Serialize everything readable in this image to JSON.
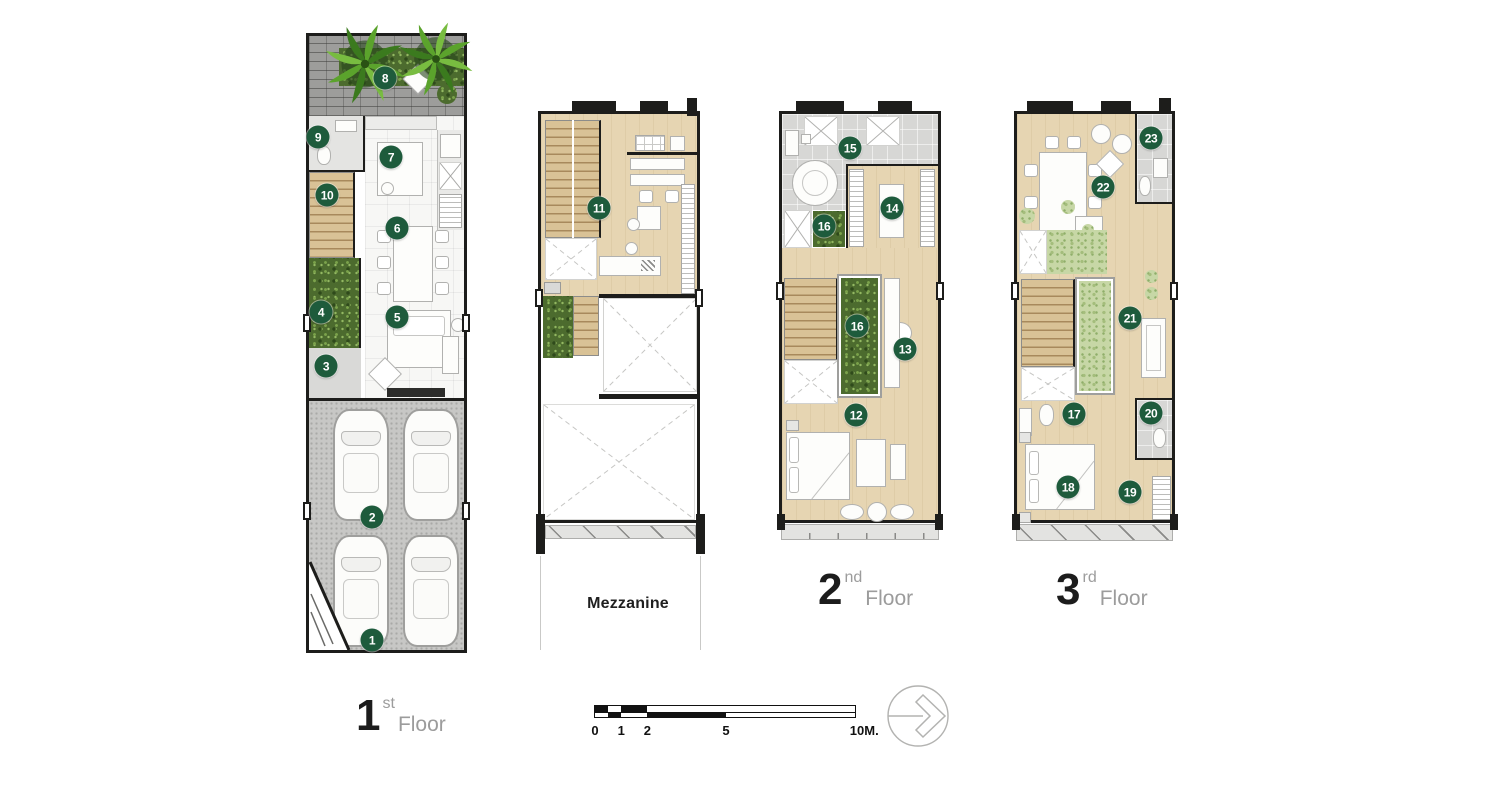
{
  "sheet": {
    "background": "#ffffff",
    "kind": "townhouse floor plans"
  },
  "floor_labels": {
    "first": {
      "number": "1",
      "ordinal": "st",
      "word": "Floor"
    },
    "mezzanine": {
      "word": "Mezzanine"
    },
    "second": {
      "number": "2",
      "ordinal": "nd",
      "word": "Floor"
    },
    "third": {
      "number": "3",
      "ordinal": "rd",
      "word": "Floor"
    }
  },
  "markers": [
    {
      "n": "1",
      "x": 372,
      "y": 640,
      "floor": "first"
    },
    {
      "n": "2",
      "x": 372,
      "y": 517,
      "floor": "first"
    },
    {
      "n": "3",
      "x": 326,
      "y": 366,
      "floor": "first"
    },
    {
      "n": "4",
      "x": 321,
      "y": 312,
      "floor": "first"
    },
    {
      "n": "5",
      "x": 397,
      "y": 317,
      "floor": "first"
    },
    {
      "n": "6",
      "x": 397,
      "y": 228,
      "floor": "first"
    },
    {
      "n": "7",
      "x": 391,
      "y": 157,
      "floor": "first"
    },
    {
      "n": "8",
      "x": 385,
      "y": 78,
      "floor": "first"
    },
    {
      "n": "9",
      "x": 318,
      "y": 137,
      "floor": "first"
    },
    {
      "n": "10",
      "x": 327,
      "y": 195,
      "floor": "first"
    },
    {
      "n": "11",
      "x": 599,
      "y": 208,
      "floor": "mezzanine"
    },
    {
      "n": "12",
      "x": 856,
      "y": 415,
      "floor": "second"
    },
    {
      "n": "13",
      "x": 905,
      "y": 349,
      "floor": "second"
    },
    {
      "n": "14",
      "x": 892,
      "y": 208,
      "floor": "second"
    },
    {
      "n": "15",
      "x": 850,
      "y": 148,
      "floor": "second"
    },
    {
      "n": "16",
      "x": 824,
      "y": 226,
      "floor": "second"
    },
    {
      "n": "16",
      "x": 857,
      "y": 326,
      "floor": "second"
    },
    {
      "n": "17",
      "x": 1074,
      "y": 414,
      "floor": "third"
    },
    {
      "n": "18",
      "x": 1068,
      "y": 487,
      "floor": "third"
    },
    {
      "n": "19",
      "x": 1130,
      "y": 492,
      "floor": "third"
    },
    {
      "n": "20",
      "x": 1151,
      "y": 413,
      "floor": "third"
    },
    {
      "n": "21",
      "x": 1130,
      "y": 318,
      "floor": "third"
    },
    {
      "n": "22",
      "x": 1103,
      "y": 187,
      "floor": "third"
    },
    {
      "n": "23",
      "x": 1151,
      "y": 138,
      "floor": "third"
    }
  ],
  "scale_bar": {
    "unit_px": 26.2,
    "total_m": 10,
    "ticks": [
      {
        "label": "0",
        "m": 0
      },
      {
        "label": "1",
        "m": 1
      },
      {
        "label": "2",
        "m": 2
      },
      {
        "label": "5",
        "m": 5
      },
      {
        "label": "10M.",
        "m": 10
      }
    ],
    "segments": [
      {
        "from": 0,
        "to": 0.5,
        "row": 0
      },
      {
        "from": 0.5,
        "to": 1,
        "row": 1
      },
      {
        "from": 1,
        "to": 2,
        "row": 0
      },
      {
        "from": 2,
        "to": 5,
        "row": 1
      }
    ]
  },
  "north_arrow": {
    "icon": "compass-chevron-east"
  },
  "palette": {
    "wall": "#1d1d1b",
    "wood_floor": "#e6d5b2",
    "stair_wood": "#d9c296",
    "tile": "#d7d7d5",
    "garage": "#c7c7c5",
    "garden_dark": "#4c6b2e",
    "garden_light": "#c7d7a6",
    "marker_green": "#1e5b3c",
    "brick": "#9d9d9b",
    "balcony": "#e3e3e1"
  }
}
